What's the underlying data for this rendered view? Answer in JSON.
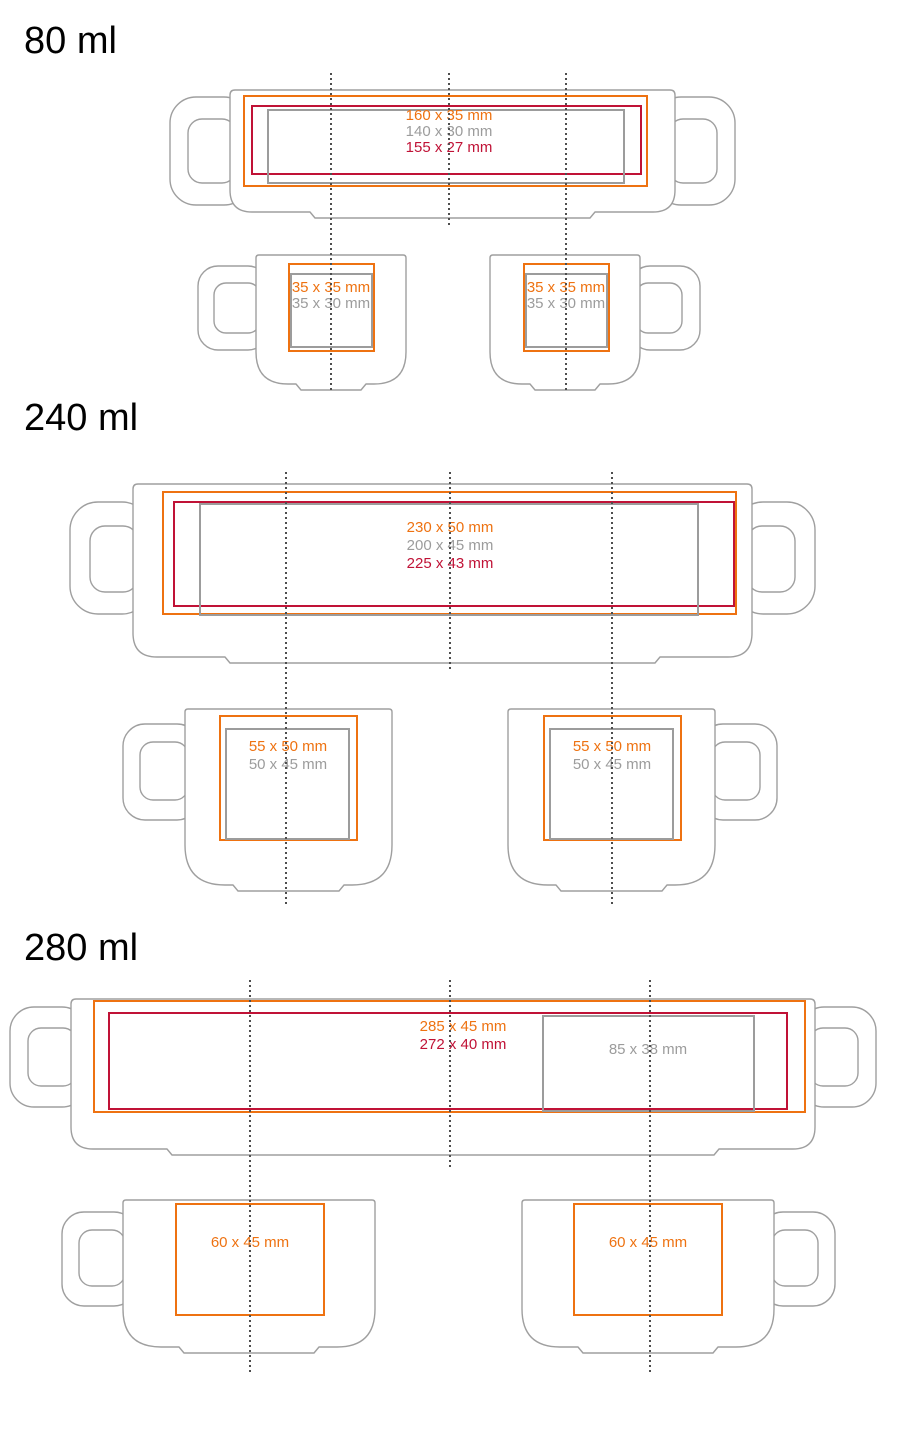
{
  "colors": {
    "orange": "#EE7211",
    "crimson": "#C01236",
    "gray": "#9C9C9C",
    "vessel_outline": "#9F9F9F",
    "guide_dots": "#4D4D4D",
    "title_text": "#000000"
  },
  "sections": [
    {
      "title": "80 ml",
      "mug": {
        "print_areas": [
          {
            "color_key": "orange",
            "label": "160 x 35 mm"
          },
          {
            "color_key": "gray",
            "label": "140 x 30 mm"
          },
          {
            "color_key": "crimson",
            "label": "155 x 27 mm"
          }
        ]
      },
      "cups": [
        {
          "print_areas": [
            {
              "color_key": "orange",
              "label": "35 x 35 mm"
            },
            {
              "color_key": "gray",
              "label": "35 x 30 mm"
            }
          ]
        },
        {
          "print_areas": [
            {
              "color_key": "orange",
              "label": "35 x 35 mm"
            },
            {
              "color_key": "gray",
              "label": "35 x 30 mm"
            }
          ]
        }
      ]
    },
    {
      "title": "240 ml",
      "mug": {
        "print_areas": [
          {
            "color_key": "orange",
            "label": "230 x 50 mm"
          },
          {
            "color_key": "gray",
            "label": "200 x 45 mm"
          },
          {
            "color_key": "crimson",
            "label": "225 x 43 mm"
          }
        ]
      },
      "cups": [
        {
          "print_areas": [
            {
              "color_key": "orange",
              "label": "55 x 50 mm"
            },
            {
              "color_key": "gray",
              "label": "50 x 45 mm"
            }
          ]
        },
        {
          "print_areas": [
            {
              "color_key": "orange",
              "label": "55 x 50 mm"
            },
            {
              "color_key": "gray",
              "label": "50 x 45 mm"
            }
          ]
        }
      ]
    },
    {
      "title": "280 ml",
      "mug": {
        "print_areas": [
          {
            "color_key": "orange",
            "label": "285 x 45 mm"
          },
          {
            "color_key": "crimson",
            "label": "272 x 40 mm"
          },
          {
            "color_key": "gray",
            "label": "85 x 38 mm"
          }
        ]
      },
      "cups": [
        {
          "print_areas": [
            {
              "color_key": "orange",
              "label": "60 x 45 mm"
            }
          ]
        },
        {
          "print_areas": [
            {
              "color_key": "orange",
              "label": "60 x 45 mm"
            }
          ]
        }
      ]
    }
  ]
}
